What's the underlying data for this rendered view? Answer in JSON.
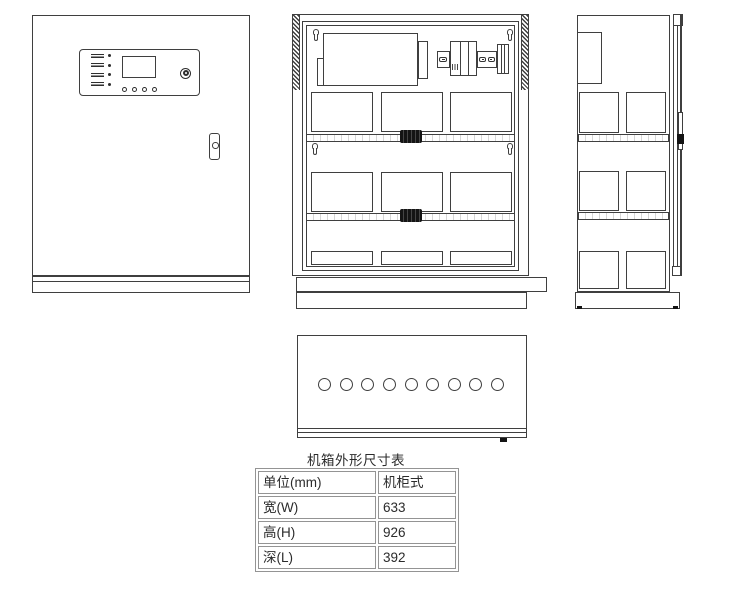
{
  "colors": {
    "line": "#3f3f3f",
    "black_fill": "#141414",
    "table_border": "#949494",
    "text": "#2b2b2b"
  },
  "dimension_table": {
    "title": "机箱外形尺寸表",
    "rows": [
      {
        "label": "单位(mm)",
        "value": "机柜式"
      },
      {
        "label": "宽(W)",
        "value": "633"
      },
      {
        "label": "高(H)",
        "value": "926"
      },
      {
        "label": "深(L)",
        "value": "392"
      }
    ]
  }
}
